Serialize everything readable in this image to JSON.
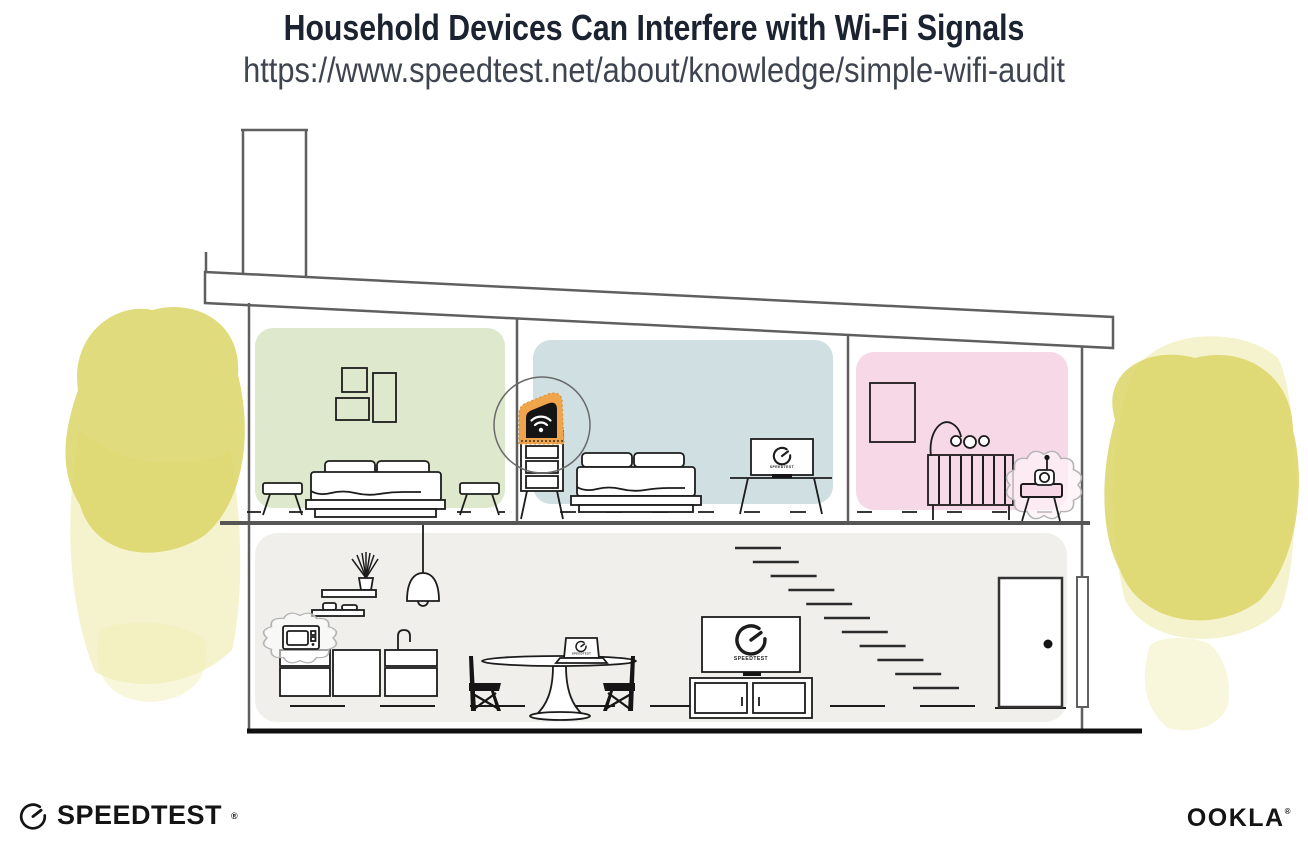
{
  "header": {
    "title": "Household Devices Can Interfere with Wi-Fi Signals",
    "url": "https://www.speedtest.net/about/knowledge/simple-wifi-audit"
  },
  "branding": {
    "speedtest_wordmark": "SPEEDTEST",
    "speedtest_reg_mark": "®",
    "ookla_wordmark": "OOKLA",
    "ookla_reg_mark": "®"
  },
  "illustration": {
    "devices": {
      "bedroom_monitor_label": "SPEEDTEST",
      "living_room_tv_label": "SPEEDTEST",
      "dining_laptop_label": "SPEEDTEST"
    },
    "colors": {
      "bedroom_left_wall": "#dee8cd",
      "bedroom_center_wall": "#cfdfe2",
      "nursery_wall": "#f6d8e7",
      "downstairs_wall": "#f0efec",
      "router_highlight": "#f0a44c",
      "foliage": "#dbd566",
      "structure_line": "#5f5f5f",
      "ink": "#1c1c1c"
    }
  }
}
